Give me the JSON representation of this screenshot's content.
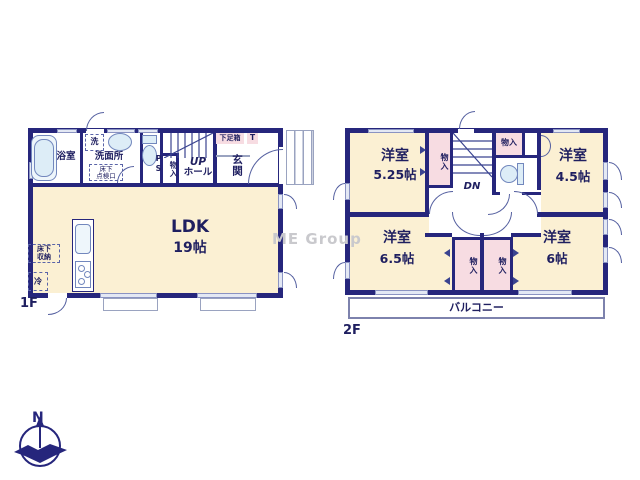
{
  "watermark": "ME Group",
  "compass": {
    "north_label": "N"
  },
  "colors": {
    "wall": "#26267c",
    "room_fill": "#fbf0d3",
    "closet_fill": "#f7dce2",
    "fixture_fill": "#ddedf7",
    "text": "#1f1f60"
  },
  "floor1": {
    "label": "1F",
    "ldk": {
      "name": "LDK",
      "area": "19帖"
    },
    "bath": {
      "name": "浴室"
    },
    "washroom": {
      "name": "洗面所",
      "washer": "洗",
      "floor_access_line1": "床下",
      "floor_access_line2": "点検口"
    },
    "toilet": {
      "ps": "PS"
    },
    "closet": {
      "name": "物入"
    },
    "stairs": {
      "up": "UP",
      "hall": "ホール"
    },
    "entrance": {
      "name": "玄関",
      "shoe_box": "下足箱",
      "t": "T"
    },
    "underfloor_storage": {
      "line1": "床下",
      "line2": "収納"
    },
    "fridge": {
      "name": "冷"
    }
  },
  "floor2": {
    "label": "2F",
    "room_nw": {
      "name": "洋室",
      "area": "5.25帖"
    },
    "room_ne": {
      "name": "洋室",
      "area": "4.5帖"
    },
    "room_sw": {
      "name": "洋室",
      "area": "6.5帖"
    },
    "room_se": {
      "name": "洋室",
      "area": "6帖"
    },
    "closet_nw": {
      "name": "物入"
    },
    "closet_n": {
      "name": "物入"
    },
    "closet_sw": {
      "name": "物入"
    },
    "closet_se": {
      "name": "物入"
    },
    "stairs": {
      "dn": "DN"
    },
    "balcony": {
      "name": "バルコニー"
    }
  }
}
